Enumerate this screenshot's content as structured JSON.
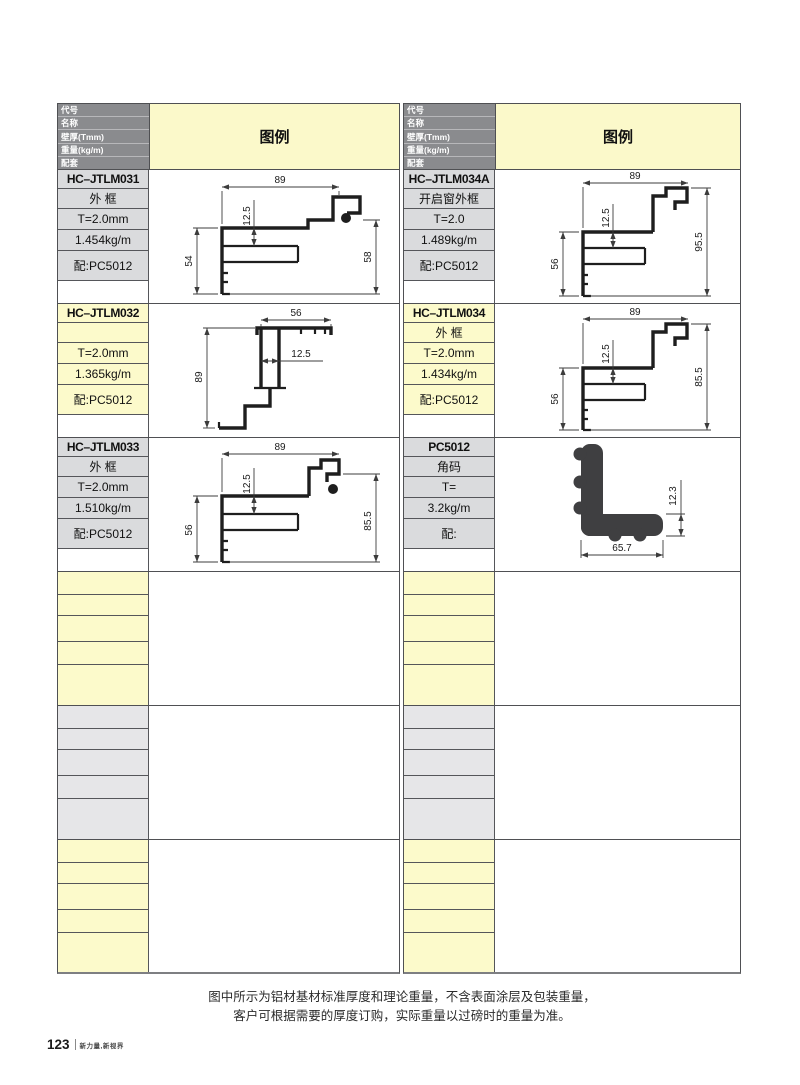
{
  "header": {
    "row_labels": [
      "代号",
      "名称",
      "壁厚(Tmm)",
      "重量(kg/m)",
      "配套"
    ],
    "legend": "图例"
  },
  "entries": [
    {
      "code": "HC–JTLM031",
      "name": "外 框",
      "thickness": "T=2.0mm",
      "weight": "1.454kg/m",
      "match": "配:PC5012",
      "dims": {
        "top": "89",
        "inner": "12.5",
        "left": "54",
        "right": "58"
      }
    },
    {
      "code": "HC–JTLM034A",
      "name": "开启窗外框",
      "thickness": "T=2.0",
      "weight": "1.489kg/m",
      "match": "配:PC5012",
      "dims": {
        "top": "89",
        "inner": "12.5",
        "left": "56",
        "right": "95.5"
      }
    },
    {
      "code": "HC–JTLM032",
      "name": "",
      "thickness": "T=2.0mm",
      "weight": "1.365kg/m",
      "match": "配:PC5012",
      "dims": {
        "top": "56",
        "inner": "12.5",
        "left": "89"
      }
    },
    {
      "code": "HC–JTLM034",
      "name": "外 框",
      "thickness": "T=2.0mm",
      "weight": "1.434kg/m",
      "match": "配:PC5012",
      "dims": {
        "top": "89",
        "inner": "12.5",
        "left": "56",
        "right": "85.5"
      }
    },
    {
      "code": "HC–JTLM033",
      "name": "外 框",
      "thickness": "T=2.0mm",
      "weight": "1.510kg/m",
      "match": "配:PC5012",
      "dims": {
        "top": "89",
        "inner": "12.5",
        "left": "56",
        "right": "85.5"
      }
    },
    {
      "code": "PC5012",
      "name": "角码",
      "thickness": "T=",
      "weight": "3.2kg/m",
      "match": "配:",
      "dims": {
        "bottom": "65.7",
        "right": "12.3"
      }
    }
  ],
  "footer": {
    "note_line1": "图中所示为铝材基材标准厚度和理论重量，不含表面涂层及包装重量，",
    "note_line2": "客户可根据需要的厚度订购，实际重量以过磅时的重量为准。",
    "page_number": "123",
    "slogan": "新力量,新视界"
  },
  "colors": {
    "header_bg": "#8a8b8e",
    "legend_bg": "#fbf9ca",
    "gray_cell": "#dadbdd",
    "yellow_cell": "#fcfacb",
    "empty_gray": "#e6e6e8",
    "border": "#4f5053"
  }
}
